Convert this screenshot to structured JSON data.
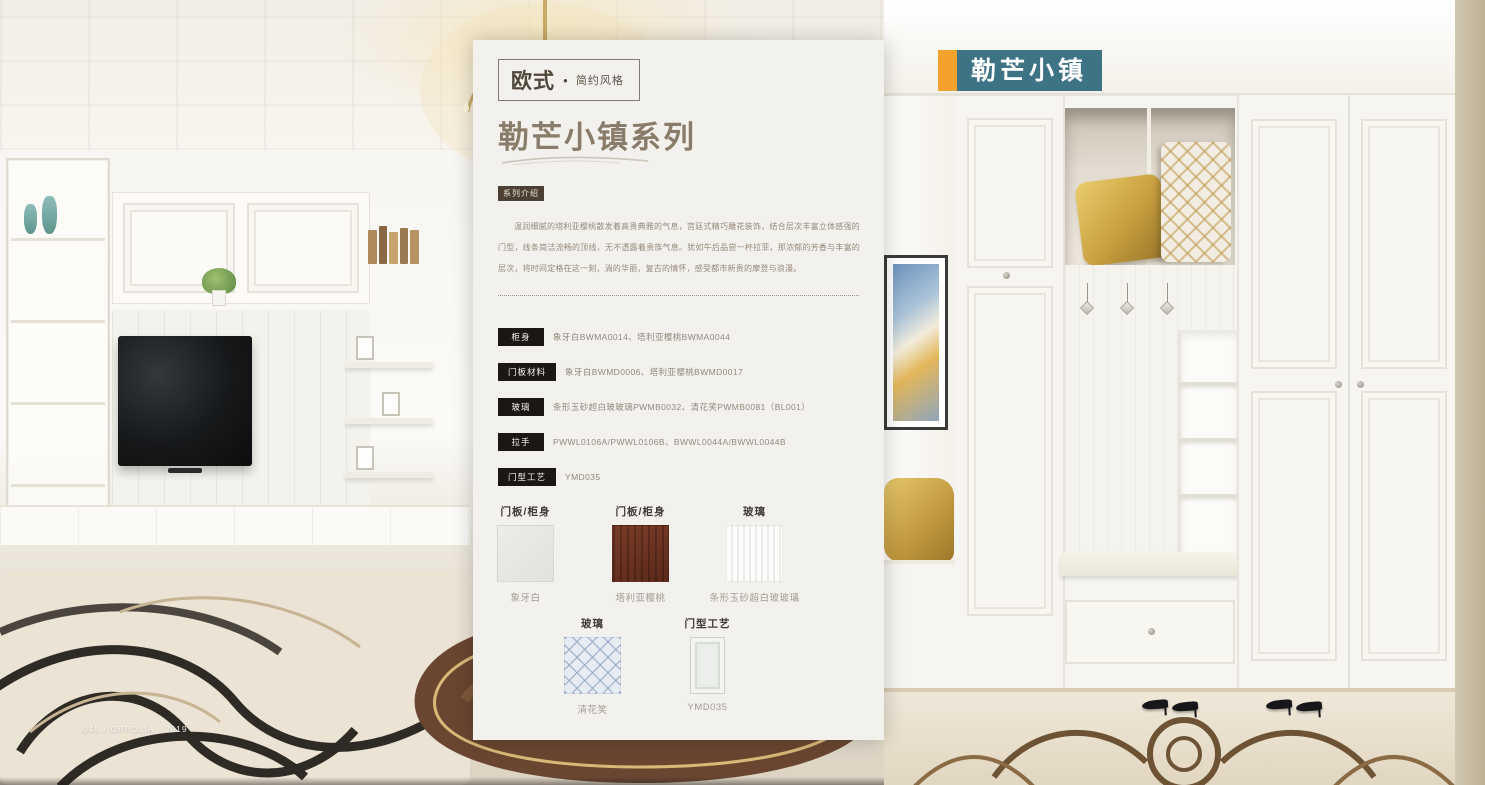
{
  "panel": {
    "style_tag": {
      "category": "欧式",
      "dot": "●",
      "sub": "简约风格"
    },
    "title": "勒芒小镇系列",
    "intro_tag": "系列介绍",
    "intro_text": "温润细腻的塔利亚樱桃散发着高贵典雅的气息，宫廷式精巧雕花装饰，结合层次丰富立体感强的门型，线条简洁流畅的顶线，无不透露着贵族气息。犹如午后品尝一杯拉菲，那浓郁的芳香与丰富的层次，将时间定格在这一刻，淌的华丽，复古的情怀，感受都市新贵的摩登与浪漫。",
    "specs": [
      {
        "label": "柜身",
        "value": "象牙白BWMA0014、塔利亚樱桃BWMA0044"
      },
      {
        "label": "门板材料",
        "value": "象牙白BWMD0006、塔利亚樱桃BWMD0017"
      },
      {
        "label": "玻璃",
        "value": "条形玉砂超白玻玻璃PWMB0032、清花笑PWMB0081（BL001）"
      },
      {
        "label": "拉手",
        "value": "PWWL0106A/PWWL0106B、BWWL0044A/BWWL0044B"
      },
      {
        "label": "门型工艺",
        "value": "YMD035"
      }
    ],
    "swatches": [
      {
        "header": "门板/柜身",
        "caption": "象牙白"
      },
      {
        "header": "门板/柜身",
        "caption": "塔利亚樱桃"
      },
      {
        "header": "玻璃",
        "caption": "条形玉砂超白玻玻璃"
      },
      {
        "header": "玻璃",
        "caption": "清花笑"
      },
      {
        "header": "门型工艺",
        "caption": "YMD035"
      }
    ]
  },
  "corner_badge": {
    "label": "勒芒小镇"
  },
  "footer": {
    "text": "045 / OPPOLIA · 2019"
  },
  "colors": {
    "accent_orange": "#f2a12d",
    "accent_teal": "#3e7386",
    "title_brown": "#8a7c6b",
    "chip_black": "#1b1713",
    "panel_bg": "#f2f1ed"
  }
}
